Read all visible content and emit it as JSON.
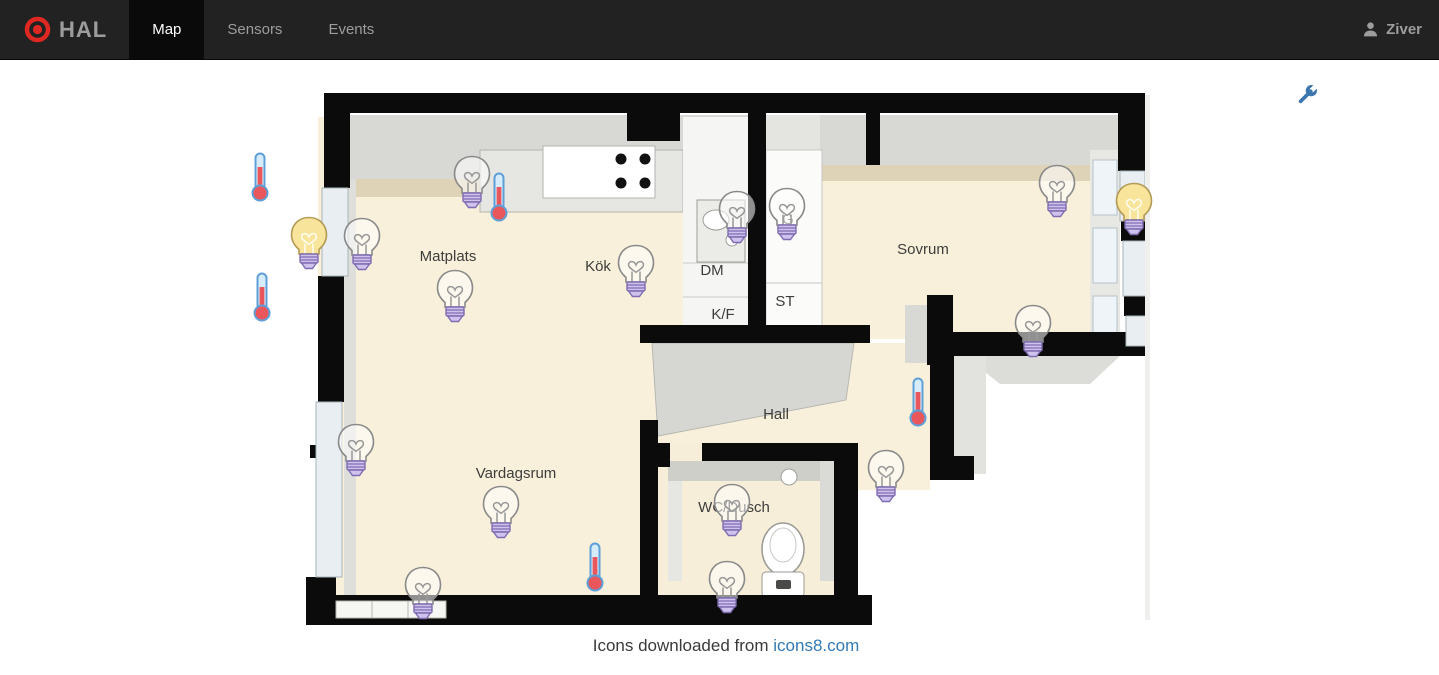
{
  "navbar": {
    "brand": "HAL",
    "tabs": [
      {
        "label": "Map",
        "active": true
      },
      {
        "label": "Sensors",
        "active": false
      },
      {
        "label": "Events",
        "active": false
      }
    ],
    "user": "Ziver"
  },
  "toolbar": {
    "wrench_icon": "settings-wrench"
  },
  "floorplan": {
    "rooms": [
      {
        "label": "Matplats",
        "x": 448,
        "y": 261
      },
      {
        "label": "Kök",
        "x": 598,
        "y": 271
      },
      {
        "label": "DM",
        "x": 712,
        "y": 275
      },
      {
        "label": "K/F",
        "x": 723,
        "y": 319
      },
      {
        "label": "ST",
        "x": 785,
        "y": 306
      },
      {
        "label": "G",
        "x": 788,
        "y": 224
      },
      {
        "label": "Sovrum",
        "x": 923,
        "y": 254
      },
      {
        "label": "Hall",
        "x": 776,
        "y": 419
      },
      {
        "label": "Vardagsrum",
        "x": 516,
        "y": 478
      },
      {
        "label": "WC/Dusch",
        "x": 734,
        "y": 512
      }
    ],
    "sensors": [
      {
        "id": "thermometer-left-upper",
        "type": "thermometer",
        "x": 260,
        "y": 177
      },
      {
        "id": "thermometer-left-lower",
        "type": "thermometer",
        "x": 262,
        "y": 297
      },
      {
        "id": "light-left-wall-on",
        "type": "light",
        "state": "on",
        "x": 309,
        "y": 243
      },
      {
        "id": "light-left-wall-off",
        "type": "light",
        "state": "off",
        "x": 362,
        "y": 244
      },
      {
        "id": "light-matplats-top",
        "type": "light",
        "state": "off",
        "x": 472,
        "y": 182
      },
      {
        "id": "thermometer-matplats",
        "type": "thermometer",
        "x": 499,
        "y": 197
      },
      {
        "id": "light-matplats",
        "type": "light",
        "state": "off",
        "x": 455,
        "y": 296
      },
      {
        "id": "light-kok",
        "type": "light",
        "state": "off",
        "x": 636,
        "y": 271
      },
      {
        "id": "light-kok-sink",
        "type": "light",
        "state": "off",
        "x": 737,
        "y": 217
      },
      {
        "id": "light-garderob",
        "type": "light",
        "state": "off",
        "x": 787,
        "y": 214
      },
      {
        "id": "light-sovrum-window",
        "type": "light",
        "state": "off",
        "x": 1057,
        "y": 191
      },
      {
        "id": "light-sovrum-wall-on",
        "type": "light",
        "state": "on",
        "x": 1134,
        "y": 209
      },
      {
        "id": "light-sovrum-south",
        "type": "light",
        "state": "off",
        "x": 1033,
        "y": 331
      },
      {
        "id": "thermometer-hall",
        "type": "thermometer",
        "x": 918,
        "y": 402
      },
      {
        "id": "light-hall",
        "type": "light",
        "state": "off",
        "x": 886,
        "y": 476
      },
      {
        "id": "light-vardagsrum-window",
        "type": "light",
        "state": "off",
        "x": 356,
        "y": 450
      },
      {
        "id": "light-vardagsrum",
        "type": "light",
        "state": "off",
        "x": 501,
        "y": 512
      },
      {
        "id": "light-vardagsrum-south",
        "type": "light",
        "state": "off",
        "x": 423,
        "y": 593
      },
      {
        "id": "thermometer-vardagsrum",
        "type": "thermometer",
        "x": 595,
        "y": 567
      },
      {
        "id": "light-wc",
        "type": "light",
        "state": "off",
        "x": 732,
        "y": 510
      },
      {
        "id": "light-wc-south",
        "type": "light",
        "state": "off",
        "x": 727,
        "y": 587
      }
    ]
  },
  "footer": {
    "text": "Icons downloaded from",
    "link_text": "icons8.com"
  },
  "colors": {
    "navbar_bg": "#222222",
    "navbar_active_bg": "#0a0a0a",
    "navbar_text": "#9d9d9d",
    "brand_logo_red": "#e02823",
    "link_blue": "#3379b6",
    "wrench_blue": "#3b76ae",
    "bulb_on_yellow": "#f8e59b",
    "bulb_base_purple": "#cfc2ec",
    "thermometer_red": "#e9565b",
    "floor_beige": "#f8f0da",
    "wall_black": "#0b0b0b"
  }
}
